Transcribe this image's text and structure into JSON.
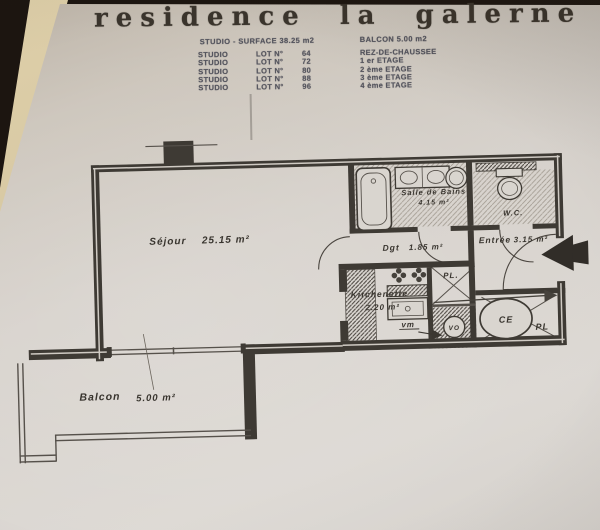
{
  "colors": {
    "background": "#1c1510",
    "page_edge": "#d6c9a8",
    "paper": "#d6d1cb",
    "ink": "#3b362f",
    "wall": "#3e3a34",
    "table_ink": "#55555e"
  },
  "title": "residence la galerne",
  "spec_header": {
    "left": "STUDIO - SURFACE 38.25 m2",
    "right": "BALCON 5.00 m2"
  },
  "lot_table": {
    "rows": [
      {
        "type": "STUDIO",
        "lot": "LOT N°",
        "number": "64",
        "floor": "REZ-DE-CHAUSSEE"
      },
      {
        "type": "STUDIO",
        "lot": "LOT N°",
        "number": "72",
        "floor": "1 er ETAGE"
      },
      {
        "type": "STUDIO",
        "lot": "LOT N°",
        "number": "80",
        "floor": "2 ème ETAGE"
      },
      {
        "type": "STUDIO",
        "lot": "LOT N°",
        "number": "88",
        "floor": "3 ème ETAGE"
      },
      {
        "type": "STUDIO",
        "lot": "LOT N°",
        "number": "96",
        "floor": "4 ème ETAGE"
      }
    ]
  },
  "plan": {
    "rooms": {
      "sejour": {
        "name": "Séjour",
        "area": "25.15 m²"
      },
      "salle_de_bains": {
        "name": "Salle de Bains",
        "area": "4.15 m²"
      },
      "wc": {
        "name": "W.C."
      },
      "degagement": {
        "name": "Dgt",
        "area": "1.85 m²"
      },
      "entree": {
        "name": "Entrée",
        "area": "3.15 m²"
      },
      "kitchenette": {
        "name": "Kitchenette",
        "area": "2.20 m²"
      },
      "balcon": {
        "name": "Balcon",
        "area": "5.00 m²"
      }
    },
    "labels": {
      "vm": "vm",
      "placard_top": "PL.",
      "placard_right": "PL",
      "chauffe_eau": "CE",
      "vide_ordures": "VO"
    }
  }
}
